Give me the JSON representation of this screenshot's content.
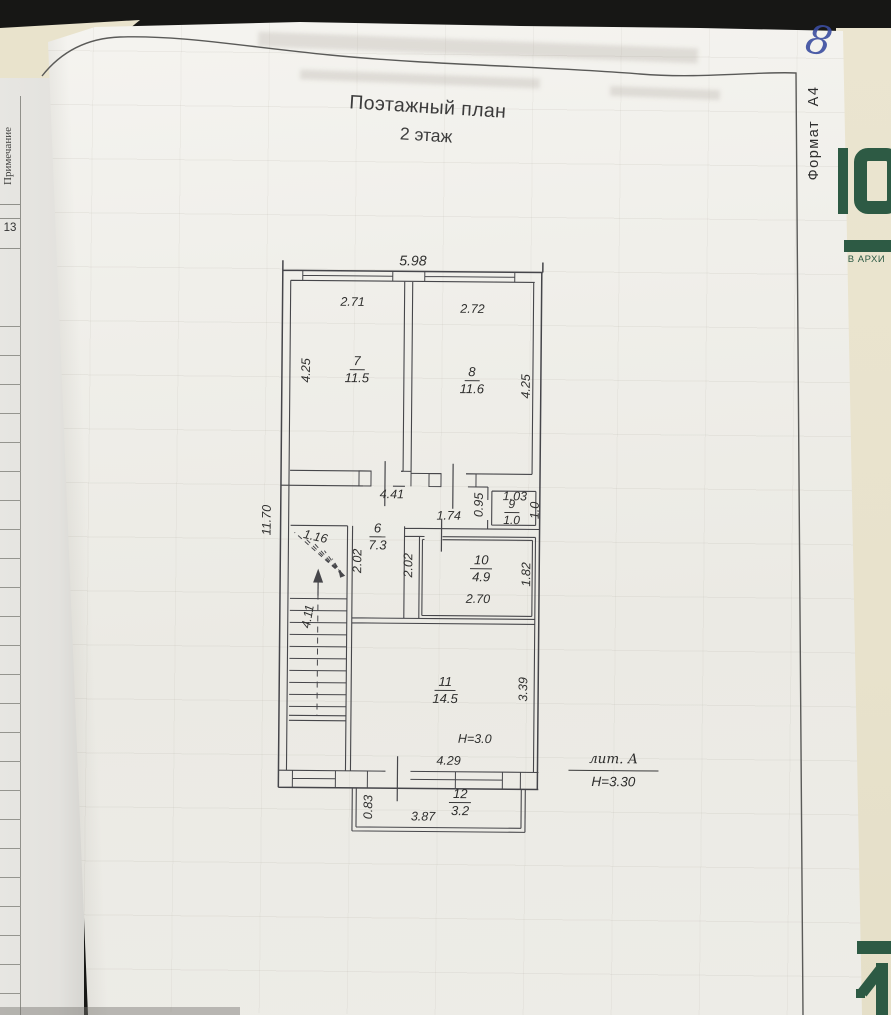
{
  "sheet": {
    "title_line1": "Поэтажный план",
    "title_line2": "2 этаж",
    "format": "Формат А4",
    "page_number": "8"
  },
  "margin": {
    "note": "Примечание",
    "row_number": "13"
  },
  "cover": {
    "archive": "В АРХИ"
  },
  "plan": {
    "total_width": "5.98",
    "total_height": "11.70",
    "rooms": {
      "r7": {
        "num": "7",
        "area": "11.5",
        "width": "2.71",
        "height": "4.25"
      },
      "r8": {
        "num": "8",
        "area": "11.6",
        "width": "2.72",
        "height": "4.25"
      },
      "r6": {
        "num": "6",
        "area": "7.3",
        "width_top": "4.41"
      },
      "r9": {
        "num": "9",
        "area": "1.0",
        "width_top": "1.03",
        "depth_left": "0.95",
        "height_right": "1.0"
      },
      "r10": {
        "num": "10",
        "area": "4.9",
        "door_top": "1.74",
        "left": "2.02",
        "right": "1.82",
        "bottom": "2.70"
      },
      "r11": {
        "num": "11",
        "area": "14.5",
        "right": "3.39",
        "ceiling": "Н=3.0",
        "bottom": "4.29"
      },
      "r12": {
        "num": "12",
        "area": "3.2",
        "left": "0.83",
        "bottom": "3.87"
      }
    },
    "stairs": {
      "top": "1.16",
      "side": "2.02",
      "corridor": "2.02",
      "left": "4.11"
    },
    "liter": {
      "label": "лит. А",
      "height": "Н=3.30"
    }
  }
}
